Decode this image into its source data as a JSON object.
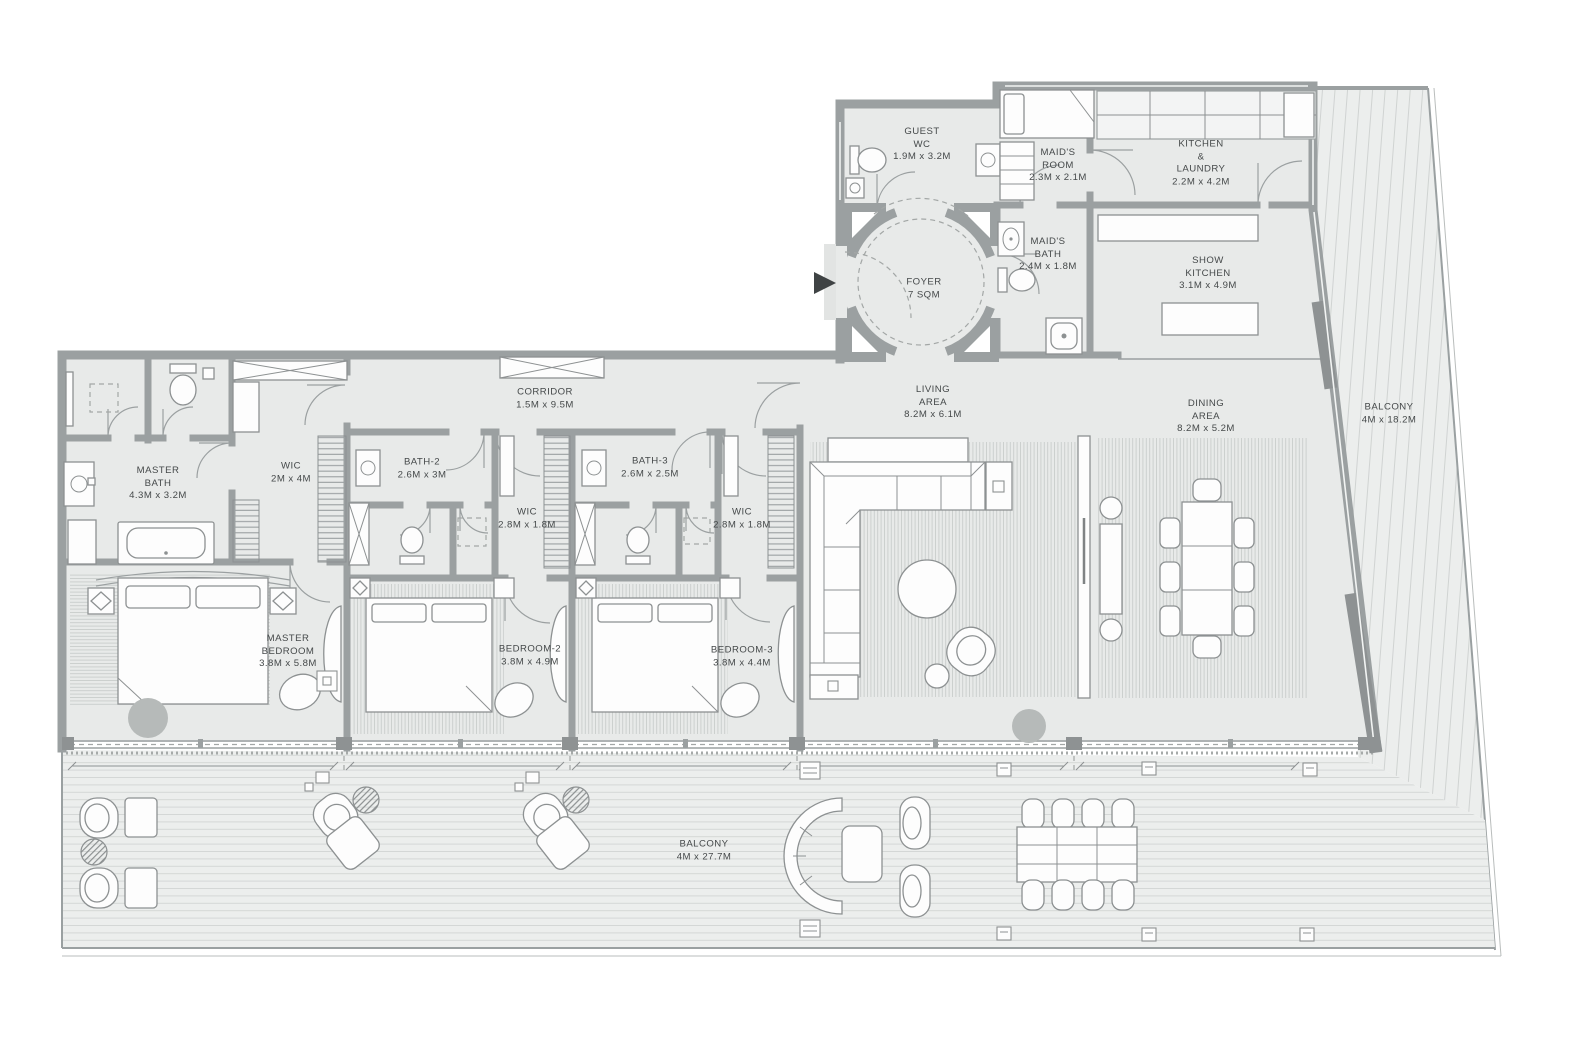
{
  "plan": {
    "type": "residential-floor-plan",
    "unit_description": "4-bedroom penthouse apartment with maid's room, foyer, two balconies"
  },
  "colors": {
    "wall": "#9ba0a1",
    "wall_dark": "#8e9293",
    "floor": "#e8eae9",
    "deck": "#eceeed",
    "pouf": "#b6bab9",
    "text": "#45494a",
    "entry_arrow": "#3f4344"
  },
  "rooms": {
    "guest_wc": {
      "text": "GUEST\nWC\n1.9M x 3.2M"
    },
    "maids_room": {
      "text": "MAID'S\nROOM\n2.3M x 2.1M"
    },
    "kitchen_laundry": {
      "text": "KITCHEN\n&\nLAUNDRY\n2.2M x 4.2M"
    },
    "maids_bath": {
      "text": "MAID'S\nBATH\n2.4M x 1.8M"
    },
    "show_kitchen": {
      "text": "SHOW\nKITCHEN\n3.1M x 4.9M"
    },
    "foyer": {
      "text": "FOYER\n7 SQM"
    },
    "corridor": {
      "text": "CORRIDOR\n1.5M x 9.5M"
    },
    "living_area": {
      "text": "LIVING\nAREA\n8.2M x 6.1M"
    },
    "dining_area": {
      "text": "DINING\nAREA\n8.2M x 5.2M"
    },
    "balcony_right": {
      "text": "BALCONY\n4M x 18.2M"
    },
    "master_bath": {
      "text": "MASTER\nBATH\n4.3M x 3.2M"
    },
    "wic_master": {
      "text": "WIC\n2M x 4M"
    },
    "bath_2": {
      "text": "BATH-2\n2.6M x 3M"
    },
    "bath_3": {
      "text": "BATH-3\n2.6M x 2.5M"
    },
    "wic_2": {
      "text": "WIC\n2.8M x 1.8M"
    },
    "wic_3": {
      "text": "WIC\n2.8M x 1.8M"
    },
    "master_bedroom": {
      "text": "MASTER\nBEDROOM\n3.8M x 5.8M"
    },
    "bedroom_2": {
      "text": "BEDROOM-2\n3.8M x 4.9M"
    },
    "bedroom_3": {
      "text": "BEDROOM-3\n3.8M x 4.4M"
    },
    "balcony_bottom": {
      "text": "BALCONY\n4M x 27.7M"
    }
  }
}
